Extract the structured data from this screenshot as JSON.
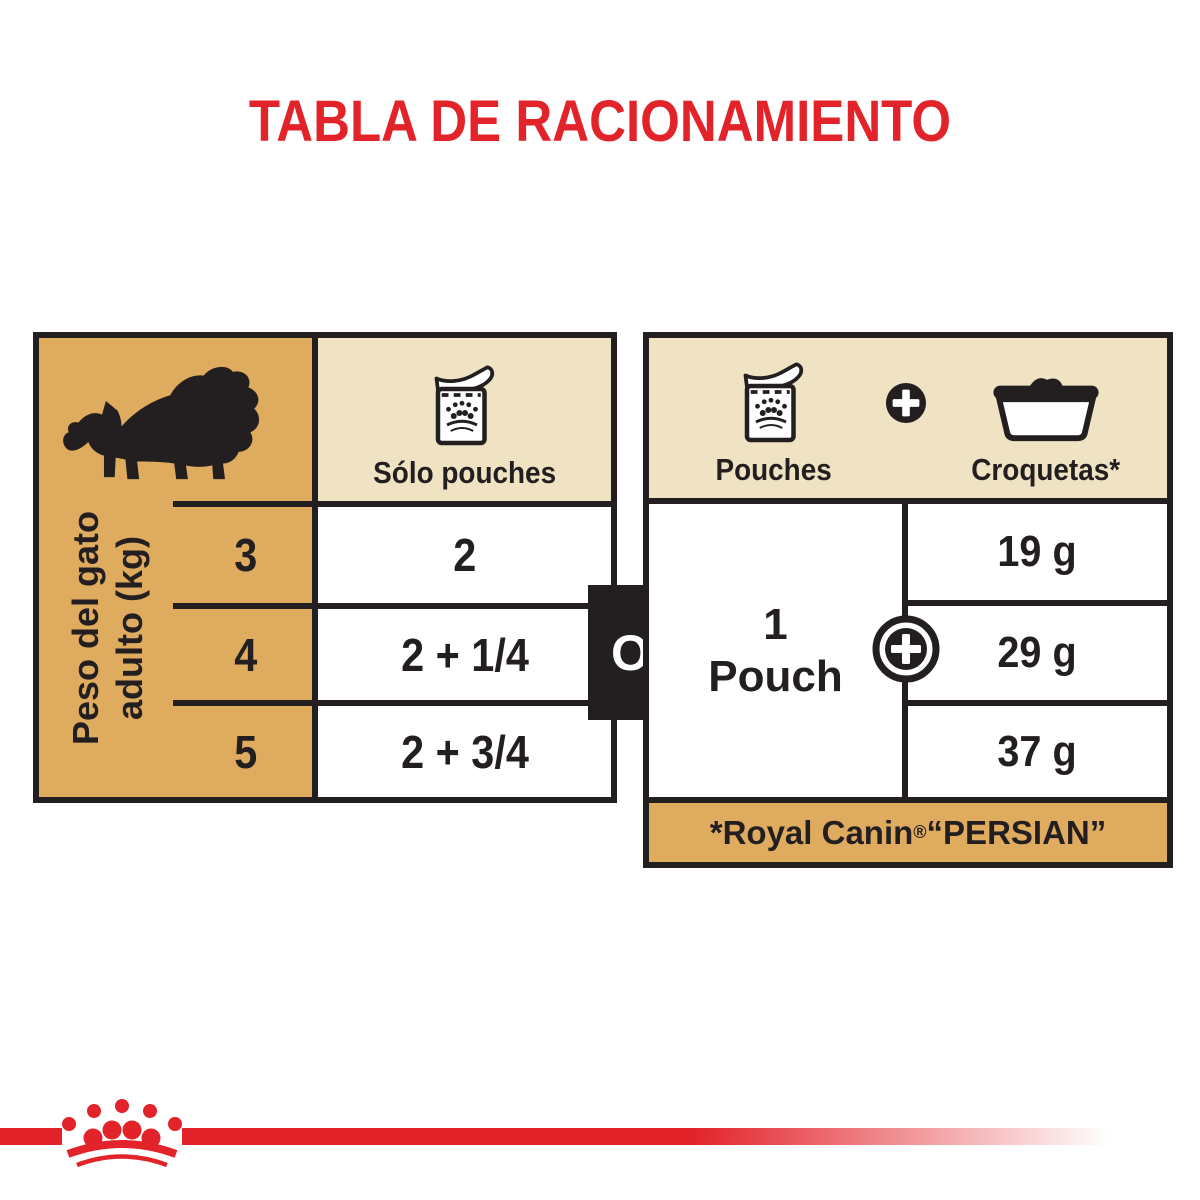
{
  "title": "TABLA DE RACIONAMIENTO",
  "colors": {
    "red": "#E2232A",
    "black": "#231F20",
    "tan": "#DFAB5F",
    "light_tan": "#F0E3C3"
  },
  "left_table": {
    "axis_label_line1": "Peso del gato",
    "axis_label_line2": "adulto (kg)",
    "column_header": "Sólo pouches",
    "rows": [
      {
        "weight_kg": "3",
        "pouches": "2"
      },
      {
        "weight_kg": "4",
        "pouches": "2 + 1/4"
      },
      {
        "weight_kg": "5",
        "pouches": "2 + 3/4"
      }
    ]
  },
  "connector": {
    "label": "O"
  },
  "right_table": {
    "header": {
      "pouches_label": "Pouches",
      "plus": "+",
      "croquetas_label": "Croquetas*"
    },
    "pouch_cell_line1": "1",
    "pouch_cell_line2": "Pouch",
    "croquetas_values": [
      "19 g",
      "29 g",
      "37 g"
    ],
    "footnote": {
      "prefix": "*Royal Canin",
      "registered": "®",
      "suffix": " “PERSIAN”"
    }
  },
  "icons": {
    "cat": "persian-cat-silhouette",
    "pouch": "food-pouch",
    "bowl": "kibble-bowl",
    "plus": "plus-sign",
    "crown": "royal-canin-crown"
  }
}
